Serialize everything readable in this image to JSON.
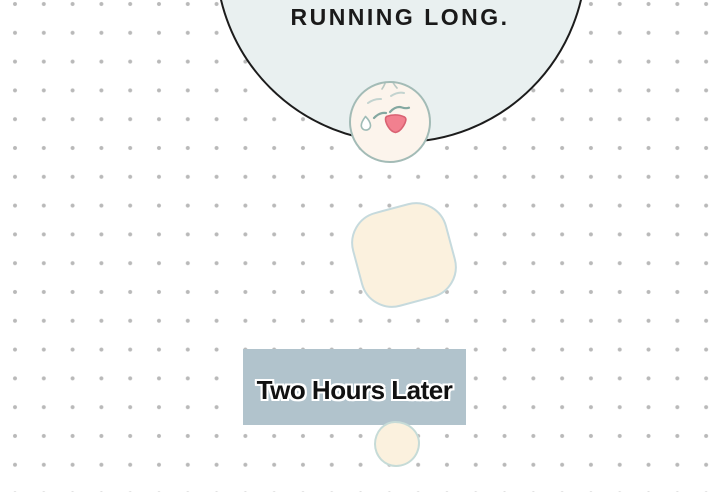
{
  "comic": {
    "speech_bubble": {
      "text": "RUNNING LONG."
    },
    "caption": {
      "text": "Two Hours Later"
    },
    "colors": {
      "background": "#ffffff",
      "dot": "#b9b9b9",
      "bubble_fill": "#e9f0f0",
      "bubble_outline": "#1c1c1c",
      "speech_text": "#1a1a1a",
      "caption_bg": "#b1c3cc",
      "caption_text": "#111111",
      "caption_text_outline": "#ffffff",
      "cream_shape_fill": "#fbf1de",
      "cream_shape_border": "#c6dadd",
      "blob_fill": "#fbf1de",
      "blob_border": "#c6dbd7",
      "skin": "#fcf4ec",
      "face_outline": "#a3bbb6",
      "brow": "#c3d3cf",
      "eye": "#84a8a1",
      "sweat_outline": "#9fbcb7",
      "sweat_fill": "#ffffff",
      "mouth_fill": "#f2808f",
      "mouth_outline": "#d96273"
    }
  }
}
